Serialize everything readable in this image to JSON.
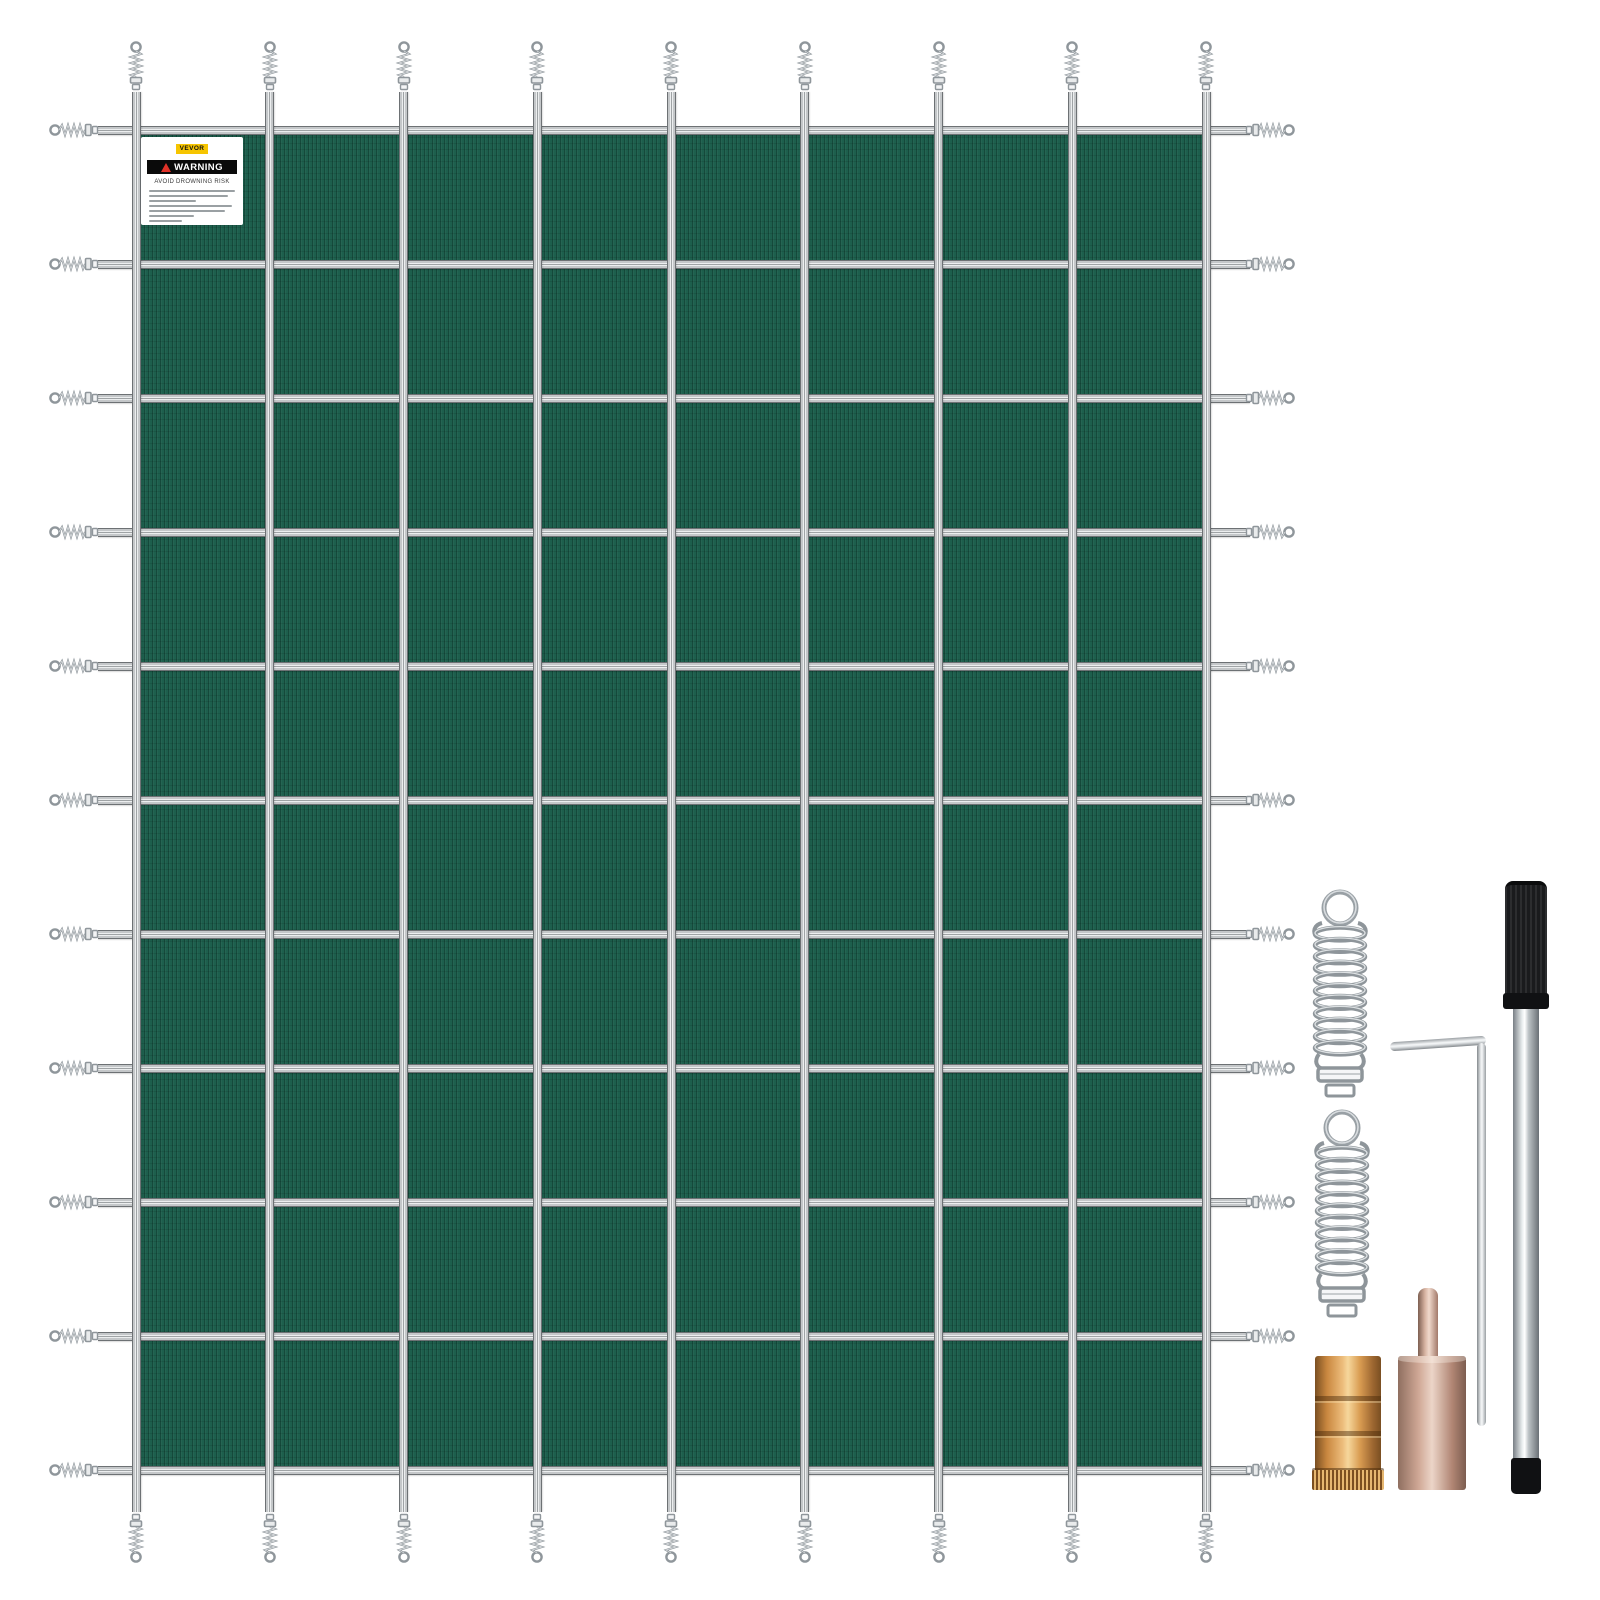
{
  "product": {
    "scene": "pool-safety-cover-kit"
  },
  "label": {
    "brand": "VEVOR",
    "warning_title": "WARNING",
    "warning_subtitle": "AVOID DROWNING RISK",
    "fine_print_line_count": 7,
    "fine_print_line_widths": [
      100,
      92,
      55,
      96,
      88,
      52,
      38
    ],
    "colors": {
      "badge_yellow": "#f6c500",
      "warning_bar": "#0a0a0a",
      "triangle_red": "#e03228"
    }
  },
  "cover": {
    "grid": {
      "vertical_straps": 9,
      "horizontal_straps": 11,
      "columns": 8,
      "rows": 10
    },
    "colors": {
      "mesh_green": "#1d5f4d",
      "strap_silver": "#c9ccce",
      "strap_edge": "#6d7174",
      "hardware_silver": "#8f969b"
    }
  },
  "hardware": {
    "items": [
      {
        "name": "anchor-spring",
        "count": 2
      },
      {
        "name": "hex-key",
        "count": 1
      },
      {
        "name": "installation-rod",
        "count": 1
      },
      {
        "name": "brass-anchor",
        "count": 1
      },
      {
        "name": "tamping-tool",
        "count": 1
      }
    ],
    "colors": {
      "handle_black": "#1a1b1d",
      "brass": "#d69a52",
      "rose_metal": "#cfa795",
      "chrome_light": "#f4f6f7"
    }
  }
}
